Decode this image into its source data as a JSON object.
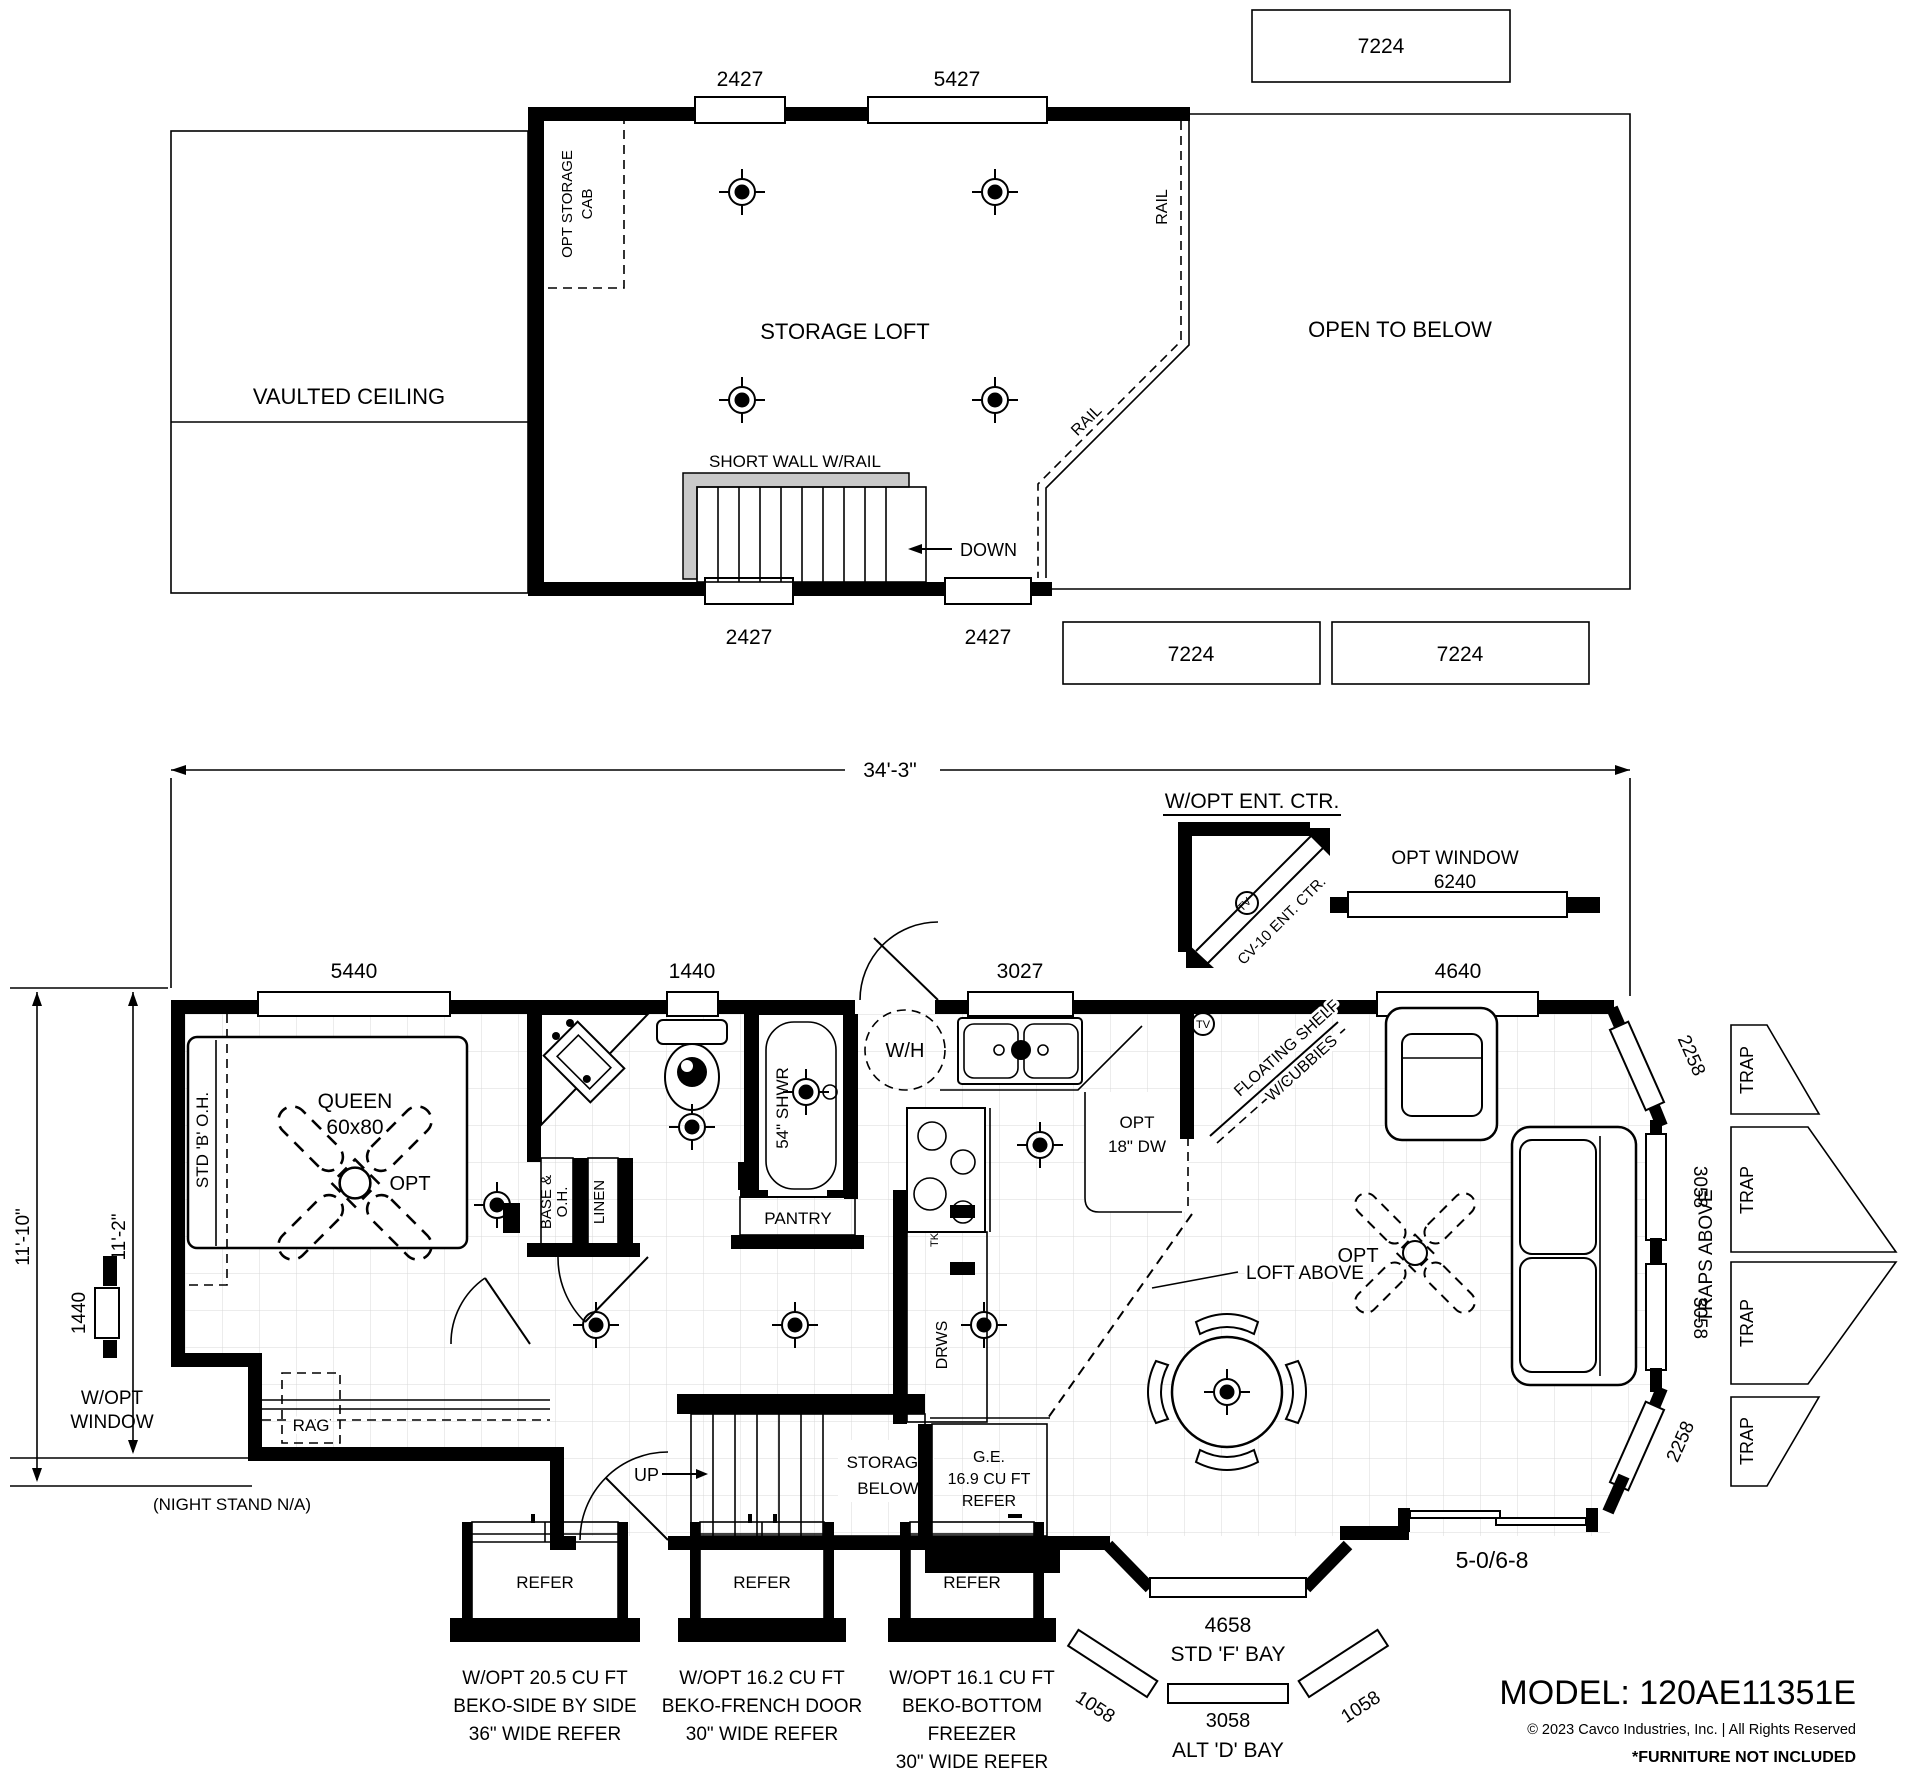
{
  "loft": {
    "title": "STORAGE LOFT",
    "vaulted": "VAULTED CEILING",
    "open_below": "OPEN TO BELOW",
    "storage_cab": [
      "OPT STORAGE",
      "CAB"
    ],
    "short_wall": "SHORT WALL W/RAIL",
    "down": "DOWN",
    "rail_side": "RAIL",
    "rail_diag": "RAIL",
    "dim_top": [
      "2427",
      "5427"
    ],
    "dim_bottom": [
      "2427",
      "2427"
    ],
    "size_boxes": [
      "7224",
      "7224",
      "7224"
    ]
  },
  "main": {
    "dim_width": "34'-3\"",
    "dim_left": [
      "11'-10\"",
      "11'-2\""
    ],
    "win_top": [
      "5440",
      "1440",
      "3027",
      "4640"
    ],
    "opt_window": [
      "OPT WINDOW",
      "6240"
    ],
    "ent_ctr_label": "W/OPT ENT. CTR.",
    "ent_ctr_unit": "CV-10 ENT. CTR.",
    "tv": "TV",
    "bedroom": {
      "bed": [
        "QUEEN",
        "60x80"
      ],
      "oh": "STD 'B' O.H.",
      "fan_opt": "OPT",
      "rag": "RAG",
      "side_win": "1440",
      "w_opt_window": [
        "W/OPT",
        "WINDOW"
      ],
      "night_stand": "(NIGHT STAND N/A)"
    },
    "bath": {
      "base_oh": [
        "BASE &",
        "O.H."
      ],
      "linen": "LINEN",
      "shower": "54\" SHWR",
      "water_heater": "W/H",
      "pantry": "PANTRY"
    },
    "kitchen": {
      "dw": [
        "OPT",
        "18\" DW"
      ],
      "drws": "DRWS",
      "tk": "TK",
      "shelf": [
        "FLOATING SHELF",
        "W/CUBBIES"
      ],
      "refer": [
        "G.E.",
        "16.9 CU FT",
        "REFER"
      ]
    },
    "stairs": {
      "up": "UP",
      "storage": [
        "STORAGE",
        "BELOW"
      ]
    },
    "loft_above": "LOFT ABOVE",
    "living": {
      "fan_opt": "OPT",
      "traps_above": "TRAPS ABOVE",
      "traps": [
        "TRAP",
        "TRAP",
        "TRAP",
        "TRAP"
      ],
      "bay_dims": [
        "2258",
        "3058",
        "3058",
        "2258"
      ],
      "door_dim": "5-0/6-8"
    },
    "f_bay": {
      "dim": "4658",
      "label": "STD 'F' BAY"
    },
    "d_bay": {
      "dims": [
        "1058",
        "3058",
        "1058"
      ],
      "label": "ALT 'D' BAY"
    }
  },
  "fridge_options": [
    {
      "name": "REFER",
      "lines": [
        "W/OPT 20.5 CU FT",
        "BEKO-SIDE BY SIDE",
        "36\" WIDE REFER"
      ]
    },
    {
      "name": "REFER",
      "lines": [
        "W/OPT 16.2 CU FT",
        "BEKO-FRENCH DOOR",
        "30\" WIDE REFER"
      ]
    },
    {
      "name": "REFER",
      "lines": [
        "W/OPT 16.1 CU FT",
        "BEKO-BOTTOM",
        "FREEZER",
        "30\" WIDE REFER"
      ]
    }
  ],
  "footer": {
    "model": "MODEL: 120AE11351E",
    "copyright": "© 2023 Cavco Industries, Inc. | All Rights Reserved",
    "furniture_note": "*FURNITURE NOT INCLUDED"
  }
}
